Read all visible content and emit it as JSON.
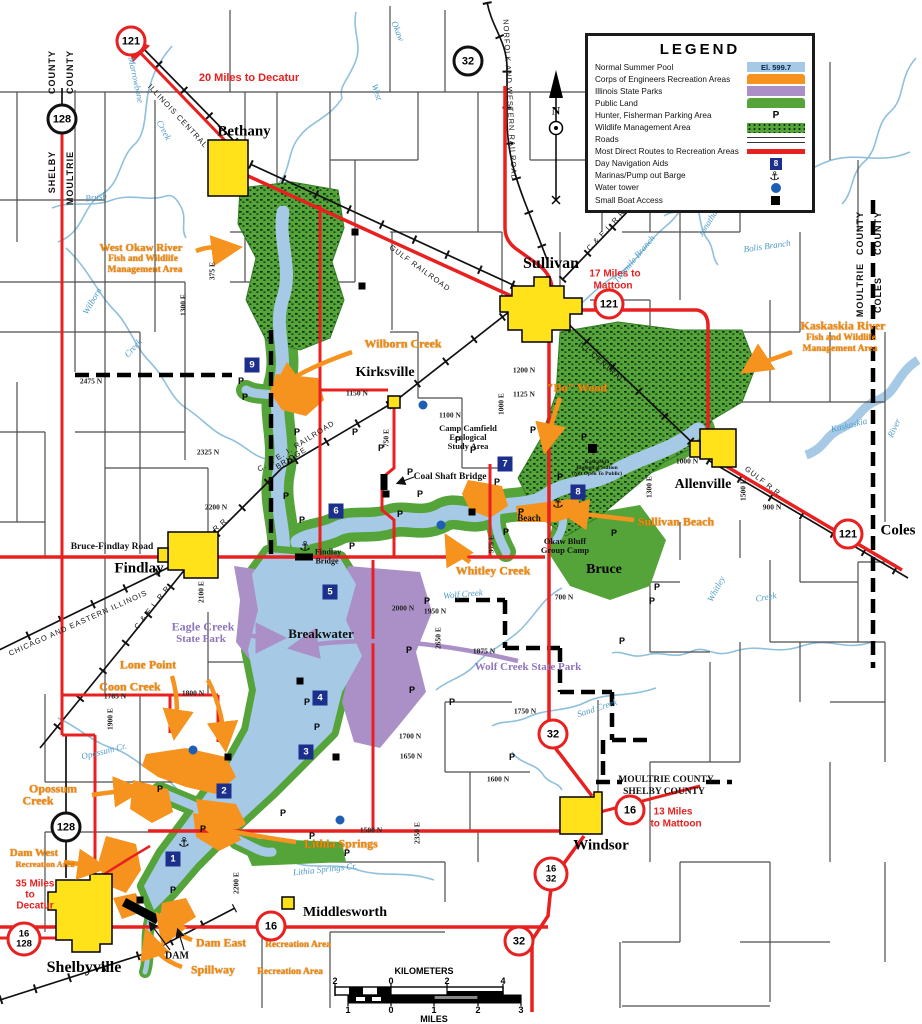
{
  "colors": {
    "pool": "#a6c9e6",
    "corps_orange": "#f6921e",
    "state_park_purple": "#ab90c8",
    "public_land_green": "#55a43a",
    "route_red": "#e8201f",
    "nav_blue": "#1c2f8c",
    "water_tower_blue": "#1d5fb5",
    "town_yellow": "#ffe21a"
  },
  "legend": {
    "title": "LEGEND",
    "items": [
      {
        "label": "Normal Summer Pool",
        "note": "El. 599.7"
      },
      {
        "label": "Corps of Engineers Recreation Areas"
      },
      {
        "label": "Illinois State Parks"
      },
      {
        "label": "Public Land"
      },
      {
        "label": "Hunter, Fisherman Parking Area"
      },
      {
        "label": "Wildlife Management Area"
      },
      {
        "label": "Roads"
      },
      {
        "label": "Most Direct Routes to Recreation Areas"
      },
      {
        "label": "Day Navigation Aids",
        "note": "8"
      },
      {
        "label": "Marinas/Pump out Barge"
      },
      {
        "label": "Water tower"
      },
      {
        "label": "Small Boat Access"
      }
    ]
  },
  "scale_bar": {
    "kilometers_label": "KILOMETERS",
    "miles_label": "MILES",
    "km_label_pos": [
      424,
      971
    ],
    "mi_label_pos": [
      434,
      1019
    ],
    "km_y": 981,
    "mi_y": 1010,
    "km_ticks": [
      {
        "t": "2",
        "x": 335
      },
      {
        "t": "0",
        "x": 391
      },
      {
        "t": "2",
        "x": 447
      },
      {
        "t": "4",
        "x": 503
      }
    ],
    "mile_ticks": [
      {
        "t": "1",
        "x": 348
      },
      {
        "t": "0",
        "x": 391
      },
      {
        "t": "1",
        "x": 434
      },
      {
        "t": "2",
        "x": 478
      },
      {
        "t": "3",
        "x": 521
      }
    ]
  },
  "route_shields": [
    {
      "text": "121",
      "color": "red",
      "x": 131,
      "y": 41
    },
    {
      "text": "128",
      "color": "black",
      "x": 62,
      "y": 119
    },
    {
      "text": "32",
      "color": "black",
      "x": 468,
      "y": 61
    },
    {
      "text": "121",
      "color": "red",
      "x": 609,
      "y": 304
    },
    {
      "text": "121",
      "color": "red",
      "x": 848,
      "y": 534
    },
    {
      "text": "32",
      "color": "red",
      "x": 553,
      "y": 734
    },
    {
      "text": "16",
      "color": "red",
      "x": 630,
      "y": 810
    },
    {
      "text": "16/32",
      "color": "red",
      "x": 551,
      "y": 874
    },
    {
      "text": "128",
      "color": "black",
      "x": 66,
      "y": 827
    },
    {
      "text": "16/128",
      "color": "red",
      "x": 24,
      "y": 939
    },
    {
      "text": "16",
      "color": "red",
      "x": 271,
      "y": 926
    },
    {
      "text": "32",
      "color": "red",
      "x": 519,
      "y": 941
    }
  ],
  "nav_aids": [
    {
      "n": "1",
      "x": 173,
      "y": 859
    },
    {
      "n": "2",
      "x": 224,
      "y": 791
    },
    {
      "n": "3",
      "x": 306,
      "y": 752
    },
    {
      "n": "4",
      "x": 320,
      "y": 698
    },
    {
      "n": "5",
      "x": 330,
      "y": 592
    },
    {
      "n": "6",
      "x": 336,
      "y": 511
    },
    {
      "n": "7",
      "x": 505,
      "y": 464
    },
    {
      "n": "8",
      "x": 578,
      "y": 492
    },
    {
      "n": "9",
      "x": 252,
      "y": 365
    }
  ],
  "markers": {
    "parking_symbol": "P",
    "anchor_symbol": "⚓",
    "parking": [
      [
        241,
        381
      ],
      [
        245,
        397
      ],
      [
        297,
        432
      ],
      [
        290,
        462
      ],
      [
        286,
        496
      ],
      [
        302,
        520
      ],
      [
        355,
        432
      ],
      [
        381,
        448
      ],
      [
        352,
        546
      ],
      [
        410,
        472
      ],
      [
        420,
        494
      ],
      [
        400,
        514
      ],
      [
        458,
        440
      ],
      [
        473,
        450
      ],
      [
        533,
        430
      ],
      [
        584,
        437
      ],
      [
        560,
        477
      ],
      [
        497,
        482
      ],
      [
        521,
        512
      ],
      [
        506,
        532
      ],
      [
        427,
        601
      ],
      [
        409,
        650
      ],
      [
        412,
        690
      ],
      [
        307,
        702
      ],
      [
        452,
        702
      ],
      [
        317,
        727
      ],
      [
        160,
        789
      ],
      [
        283,
        813
      ],
      [
        203,
        829
      ],
      [
        312,
        836
      ],
      [
        347,
        853
      ],
      [
        173,
        890
      ],
      [
        622,
        641
      ],
      [
        657,
        587
      ],
      [
        614,
        533
      ],
      [
        652,
        601
      ],
      [
        512,
        757
      ]
    ],
    "boats": [
      [
        355,
        232
      ],
      [
        362,
        286
      ],
      [
        386,
        494
      ],
      [
        472,
        512
      ],
      [
        592,
        449
      ],
      [
        300,
        681
      ],
      [
        228,
        757
      ],
      [
        336,
        757
      ],
      [
        140,
        900
      ]
    ],
    "water_towers": [
      [
        423,
        405
      ],
      [
        441,
        525
      ],
      [
        193,
        750
      ],
      [
        340,
        820
      ]
    ],
    "anchors": [
      [
        305,
        547
      ],
      [
        558,
        504
      ],
      [
        184,
        843
      ]
    ]
  },
  "map_labels": [
    {
      "t": "Bethany",
      "x": 244,
      "y": 132,
      "c": "town",
      "fs": 15
    },
    {
      "t": "Sullivan",
      "x": 551,
      "y": 264,
      "c": "town",
      "fs": 16
    },
    {
      "t": "Kirksville",
      "x": 385,
      "y": 373,
      "c": "town",
      "fs": 14
    },
    {
      "t": "Findlay",
      "x": 139,
      "y": 569,
      "c": "town",
      "fs": 15
    },
    {
      "t": "Allenville",
      "x": 703,
      "y": 485,
      "c": "town",
      "fs": 14
    },
    {
      "t": "Shelbyville",
      "x": 84,
      "y": 968,
      "c": "town",
      "fs": 16
    },
    {
      "t": "Windsor",
      "x": 601,
      "y": 846,
      "c": "town",
      "fs": 15
    },
    {
      "t": "Middlesworth",
      "x": 345,
      "y": 913,
      "c": "town",
      "fs": 14
    },
    {
      "t": "Coles",
      "x": 898,
      "y": 531,
      "c": "town",
      "fs": 15
    },
    {
      "t": "Bruce",
      "x": 604,
      "y": 570,
      "c": "town",
      "fs": 14
    },
    {
      "t": "20 Miles to Decatur",
      "x": 249,
      "y": 78,
      "c": "red",
      "fs": 11
    },
    {
      "t": "17 Miles to",
      "x": 615,
      "y": 274,
      "c": "red"
    },
    {
      "t": "Mattoon",
      "x": 613,
      "y": 286,
      "c": "red"
    },
    {
      "t": "13 Miles",
      "x": 673,
      "y": 812,
      "c": "red"
    },
    {
      "t": "to Mattoon",
      "x": 676,
      "y": 824,
      "c": "red"
    },
    {
      "t": "35 Miles",
      "x": 35,
      "y": 884,
      "c": "red"
    },
    {
      "t": "to",
      "x": 30,
      "y": 895,
      "c": "red"
    },
    {
      "t": "Decatur",
      "x": 35,
      "y": 906,
      "c": "red"
    },
    {
      "t": "West Okaw River",
      "x": 141,
      "y": 248,
      "c": "or",
      "fs": 11
    },
    {
      "t": "Fish and Wildlife",
      "x": 143,
      "y": 259,
      "c": "or",
      "fs": 9.5
    },
    {
      "t": "Management Area",
      "x": 145,
      "y": 270,
      "c": "or",
      "fs": 9.5
    },
    {
      "t": "Wilborn Creek",
      "x": 403,
      "y": 344,
      "c": "or",
      "fs": 12
    },
    {
      "t": "\"Bo\" Wood",
      "x": 577,
      "y": 388,
      "c": "or",
      "fs": 12
    },
    {
      "t": "Kaskaskia River",
      "x": 843,
      "y": 326,
      "c": "or",
      "fs": 12
    },
    {
      "t": "Fish and Wildlife",
      "x": 841,
      "y": 338,
      "c": "or",
      "fs": 9.5
    },
    {
      "t": "Management Area",
      "x": 840,
      "y": 349,
      "c": "or",
      "fs": 9.5
    },
    {
      "t": "Sullivan Beach",
      "x": 676,
      "y": 522,
      "c": "or",
      "fs": 12
    },
    {
      "t": "Whitley Creek",
      "x": 493,
      "y": 571,
      "c": "or",
      "fs": 12
    },
    {
      "t": "Lone Point",
      "x": 148,
      "y": 665,
      "c": "or",
      "fs": 12
    },
    {
      "t": "Coon Creek",
      "x": 130,
      "y": 687,
      "c": "or",
      "fs": 12
    },
    {
      "t": "Opossum",
      "x": 53,
      "y": 789,
      "c": "or",
      "fs": 12
    },
    {
      "t": "Creek",
      "x": 38,
      "y": 801,
      "c": "or",
      "fs": 12
    },
    {
      "t": "Dam West",
      "x": 34,
      "y": 853,
      "c": "or",
      "fs": 11
    },
    {
      "t": "Recreation Area",
      "x": 45,
      "y": 864,
      "c": "or",
      "fs": 8.5
    },
    {
      "t": "Lithia Springs",
      "x": 341,
      "y": 844,
      "c": "or",
      "fs": 12
    },
    {
      "t": "Dam East",
      "x": 221,
      "y": 943,
      "c": "or",
      "fs": 12
    },
    {
      "t": "Recreation Area",
      "x": 298,
      "y": 945,
      "c": "or",
      "fs": 9.5
    },
    {
      "t": "Spillway",
      "x": 213,
      "y": 970,
      "c": "or",
      "fs": 12
    },
    {
      "t": "Recreation Area",
      "x": 290,
      "y": 972,
      "c": "or",
      "fs": 9.5
    },
    {
      "t": "Eagle Creek",
      "x": 203,
      "y": 627,
      "c": "pu",
      "fs": 12
    },
    {
      "t": "State Park",
      "x": 201,
      "y": 639,
      "c": "pu",
      "fs": 11
    },
    {
      "t": "Wolf Creek State Park",
      "x": 528,
      "y": 667,
      "c": "pu",
      "fs": 11
    },
    {
      "t": "Marrowbone",
      "x": 136,
      "y": 80,
      "c": "bl",
      "r": 78
    },
    {
      "t": "Creek",
      "x": 164,
      "y": 130,
      "c": "bl",
      "r": 62
    },
    {
      "t": "Brush",
      "x": 96,
      "y": 197,
      "c": "bl",
      "r": -8
    },
    {
      "t": "West",
      "x": 377,
      "y": 92,
      "c": "bl",
      "r": 72
    },
    {
      "t": "Okaw",
      "x": 398,
      "y": 31,
      "c": "bl",
      "r": 68
    },
    {
      "t": "Twomile Branch",
      "x": 634,
      "y": 259,
      "c": "bl",
      "r": -50
    },
    {
      "t": "Bolis Branch",
      "x": 767,
      "y": 246,
      "c": "bl",
      "r": -8
    },
    {
      "t": "Jonathan Cr.",
      "x": 712,
      "y": 216,
      "c": "bl",
      "r": -58
    },
    {
      "t": "Kaskaskia",
      "x": 849,
      "y": 425,
      "c": "bl",
      "r": -14
    },
    {
      "t": "River",
      "x": 894,
      "y": 428,
      "c": "bl",
      "r": -65
    },
    {
      "t": "Whitley",
      "x": 716,
      "y": 589,
      "c": "bl",
      "r": -62
    },
    {
      "t": "Creek",
      "x": 766,
      "y": 597,
      "c": "bl",
      "r": -10
    },
    {
      "t": "Wolf Creek",
      "x": 463,
      "y": 594,
      "c": "bl",
      "r": -5
    },
    {
      "t": "Sand Creek",
      "x": 597,
      "y": 708,
      "c": "bl",
      "r": -18
    },
    {
      "t": "Opossum Cr.",
      "x": 104,
      "y": 751,
      "c": "bl",
      "r": -14
    },
    {
      "t": "Lithia Springs Cr.",
      "x": 325,
      "y": 869,
      "c": "bl",
      "r": -6
    },
    {
      "t": "Wilborn",
      "x": 92,
      "y": 301,
      "c": "bl",
      "r": -60
    },
    {
      "t": "Creek",
      "x": 133,
      "y": 348,
      "c": "bl",
      "r": -48
    },
    {
      "t": "Camp Camfield",
      "x": 468,
      "y": 428,
      "c": "bk",
      "fs": 8.5
    },
    {
      "t": "Ecological",
      "x": 468,
      "y": 437,
      "c": "bk",
      "fs": 8.5
    },
    {
      "t": "Study Area",
      "x": 468,
      "y": 446,
      "c": "bk",
      "fs": 8.5
    },
    {
      "t": "Coal Shaft Bridge",
      "x": 450,
      "y": 477,
      "c": "bk",
      "fs": 9.5
    },
    {
      "t": "Findlay",
      "x": 328,
      "y": 552,
      "c": "bk",
      "fs": 8
    },
    {
      "t": "Bridge",
      "x": 327,
      "y": 561,
      "c": "bk",
      "fs": 8
    },
    {
      "t": "Breakwater",
      "x": 321,
      "y": 634,
      "c": "bk",
      "fs": 13,
      "nm": "breakwater-label"
    },
    {
      "t": "Okaw Bluff",
      "x": 565,
      "y": 541,
      "c": "bk",
      "fs": 8.5
    },
    {
      "t": "Group Camp",
      "x": 565,
      "y": 550,
      "c": "bk",
      "fs": 8.5
    },
    {
      "t": "Kaskaskia",
      "x": 597,
      "y": 462,
      "c": "bk",
      "fs": 5.5
    },
    {
      "t": "Biological Station",
      "x": 597,
      "y": 468,
      "c": "bk",
      "fs": 5.5
    },
    {
      "t": "(Not Open To Public)",
      "x": 597,
      "y": 474,
      "c": "bk",
      "fs": 5.5
    },
    {
      "t": "MOULTRIE COUNTY",
      "x": 666,
      "y": 780,
      "c": "bk",
      "fs": 9.5
    },
    {
      "t": "SHELBY COUNTY",
      "x": 664,
      "y": 792,
      "c": "bk",
      "fs": 9.5
    },
    {
      "t": "DAM",
      "x": 177,
      "y": 956,
      "c": "bk",
      "fs": 10
    },
    {
      "t": "Bruce-Findlay Road",
      "x": 112,
      "y": 547,
      "c": "bk",
      "fs": 9.5
    },
    {
      "t": "Beach",
      "x": 529,
      "y": 518,
      "c": "bk",
      "fs": 9
    },
    {
      "t": "ILLINOIS CENTRAL",
      "x": 178,
      "y": 116,
      "c": "rr",
      "r": 47
    },
    {
      "t": "NORFOLK AND WESTERN RAILROAD",
      "x": 510,
      "y": 100,
      "c": "rr",
      "r": 87
    },
    {
      "t": "ILL CENTRAL",
      "x": 602,
      "y": 362,
      "c": "rr",
      "r": 41
    },
    {
      "t": "GULF  RAILROAD",
      "x": 420,
      "y": 268,
      "c": "rr",
      "r": 36
    },
    {
      "t": "GULF R.R.",
      "x": 764,
      "y": 482,
      "c": "rr",
      "r": 38
    },
    {
      "t": "C. & E. I. RAILROAD",
      "x": 296,
      "y": 446,
      "c": "rr",
      "r": -32
    },
    {
      "t": "BRIDGE",
      "x": 291,
      "y": 458,
      "c": "rr",
      "r": -32
    },
    {
      "t": "CHICAGO AND EASTERN ILLINOIS",
      "x": 78,
      "y": 623,
      "c": "rr",
      "r": -24
    },
    {
      "t": "C & E I. R.R.",
      "x": 153,
      "y": 606,
      "c": "rr",
      "r": -52
    },
    {
      "t": "R.R.",
      "x": 221,
      "y": 524,
      "c": "rr",
      "r": -40
    },
    {
      "t": "C.& E.I. R.R.",
      "x": 607,
      "y": 229,
      "c": "rr",
      "r": -47
    },
    {
      "t": "2475 N",
      "x": 91,
      "y": 381,
      "c": "gr"
    },
    {
      "t": "375 E",
      "x": 212,
      "y": 271,
      "c": "gr",
      "r": -90
    },
    {
      "t": "1300 E",
      "x": 183,
      "y": 305,
      "c": "gr",
      "r": -90
    },
    {
      "t": "2325 N",
      "x": 208,
      "y": 452,
      "c": "gr"
    },
    {
      "t": "2200 N",
      "x": 216,
      "y": 507,
      "c": "gr"
    },
    {
      "t": "2100 E",
      "x": 201,
      "y": 592,
      "c": "gr",
      "r": -90
    },
    {
      "t": "1150 N",
      "x": 357,
      "y": 393,
      "c": "gr"
    },
    {
      "t": "1100 N",
      "x": 450,
      "y": 415,
      "c": "gr"
    },
    {
      "t": "1200 N",
      "x": 524,
      "y": 370,
      "c": "gr"
    },
    {
      "t": "1125 N",
      "x": 524,
      "y": 394,
      "c": "gr"
    },
    {
      "t": "1000 E",
      "x": 501,
      "y": 404,
      "c": "gr",
      "r": -90
    },
    {
      "t": "1000 N",
      "x": 687,
      "y": 461,
      "c": "gr"
    },
    {
      "t": "900 N",
      "x": 772,
      "y": 507,
      "c": "gr"
    },
    {
      "t": "1300 E",
      "x": 649,
      "y": 487,
      "c": "gr",
      "r": -90
    },
    {
      "t": "1500 E",
      "x": 743,
      "y": 490,
      "c": "gr",
      "r": -90
    },
    {
      "t": "750 E",
      "x": 386,
      "y": 438,
      "c": "gr",
      "r": -90
    },
    {
      "t": "975 E",
      "x": 491,
      "y": 544,
      "c": "gr",
      "r": -90
    },
    {
      "t": "700 N",
      "x": 564,
      "y": 597,
      "c": "gr"
    },
    {
      "t": "2000 N",
      "x": 403,
      "y": 608,
      "c": "gr"
    },
    {
      "t": "1950 N",
      "x": 435,
      "y": 611,
      "c": "gr"
    },
    {
      "t": "2650 E",
      "x": 438,
      "y": 638,
      "c": "gr",
      "r": -90
    },
    {
      "t": "1875 N",
      "x": 484,
      "y": 651,
      "c": "gr"
    },
    {
      "t": "1750 N",
      "x": 525,
      "y": 711,
      "c": "gr"
    },
    {
      "t": "1700 N",
      "x": 410,
      "y": 736,
      "c": "gr"
    },
    {
      "t": "1650 N",
      "x": 411,
      "y": 756,
      "c": "gr"
    },
    {
      "t": "1600 N",
      "x": 498,
      "y": 779,
      "c": "gr"
    },
    {
      "t": "1500 N",
      "x": 371,
      "y": 830,
      "c": "gr"
    },
    {
      "t": "1785 N",
      "x": 115,
      "y": 696,
      "c": "gr"
    },
    {
      "t": "1800 N",
      "x": 193,
      "y": 693,
      "c": "gr"
    },
    {
      "t": "1900 E",
      "x": 110,
      "y": 719,
      "c": "gr",
      "r": -90
    },
    {
      "t": "2200 E",
      "x": 236,
      "y": 883,
      "c": "gr",
      "r": -90
    },
    {
      "t": "2350 E",
      "x": 417,
      "y": 833,
      "c": "gr",
      "r": -90
    },
    {
      "t": "COUNTY",
      "x": 52,
      "y": 72,
      "c": "co",
      "r": -90
    },
    {
      "t": "COUNTY",
      "x": 70,
      "y": 72,
      "c": "co",
      "r": -90
    },
    {
      "t": "SHELBY",
      "x": 52,
      "y": 172,
      "c": "co",
      "r": -90
    },
    {
      "t": "MOULTRIE",
      "x": 70,
      "y": 178,
      "c": "co",
      "r": -90
    },
    {
      "t": "COUNTY",
      "x": 860,
      "y": 233,
      "c": "co",
      "r": -90
    },
    {
      "t": "COUNTY",
      "x": 878,
      "y": 233,
      "c": "co",
      "r": -90
    },
    {
      "t": "MOULTRIE",
      "x": 860,
      "y": 290,
      "c": "co",
      "r": -90
    },
    {
      "t": "COLES",
      "x": 878,
      "y": 295,
      "c": "co",
      "r": -90
    },
    {
      "t": "N",
      "x": 556,
      "y": 111,
      "c": "cp",
      "nm": "compass-north-label"
    }
  ]
}
